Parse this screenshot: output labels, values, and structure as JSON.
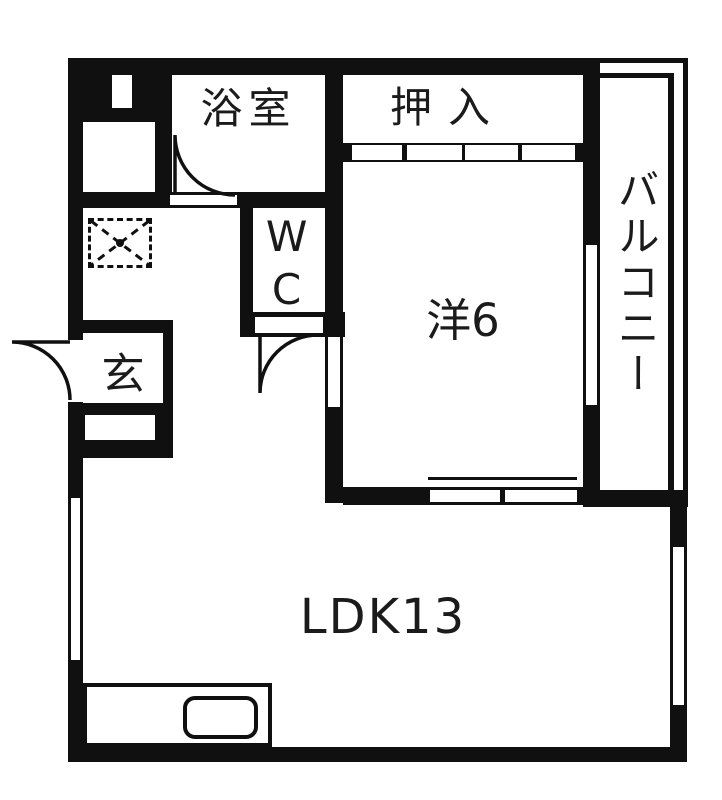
{
  "floorplan": {
    "colors": {
      "wall": "#101010",
      "floor": "#ffffff",
      "text": "#1b1b1b"
    },
    "rooms": {
      "bathroom": {
        "label": "浴室"
      },
      "closet": {
        "label": "押入"
      },
      "wc": {
        "label": "WC"
      },
      "western_room": {
        "label": "洋6"
      },
      "balcony": {
        "label": "バルコニー"
      },
      "entrance": {
        "label": "玄"
      },
      "ldk": {
        "label": "LDK13"
      }
    }
  }
}
